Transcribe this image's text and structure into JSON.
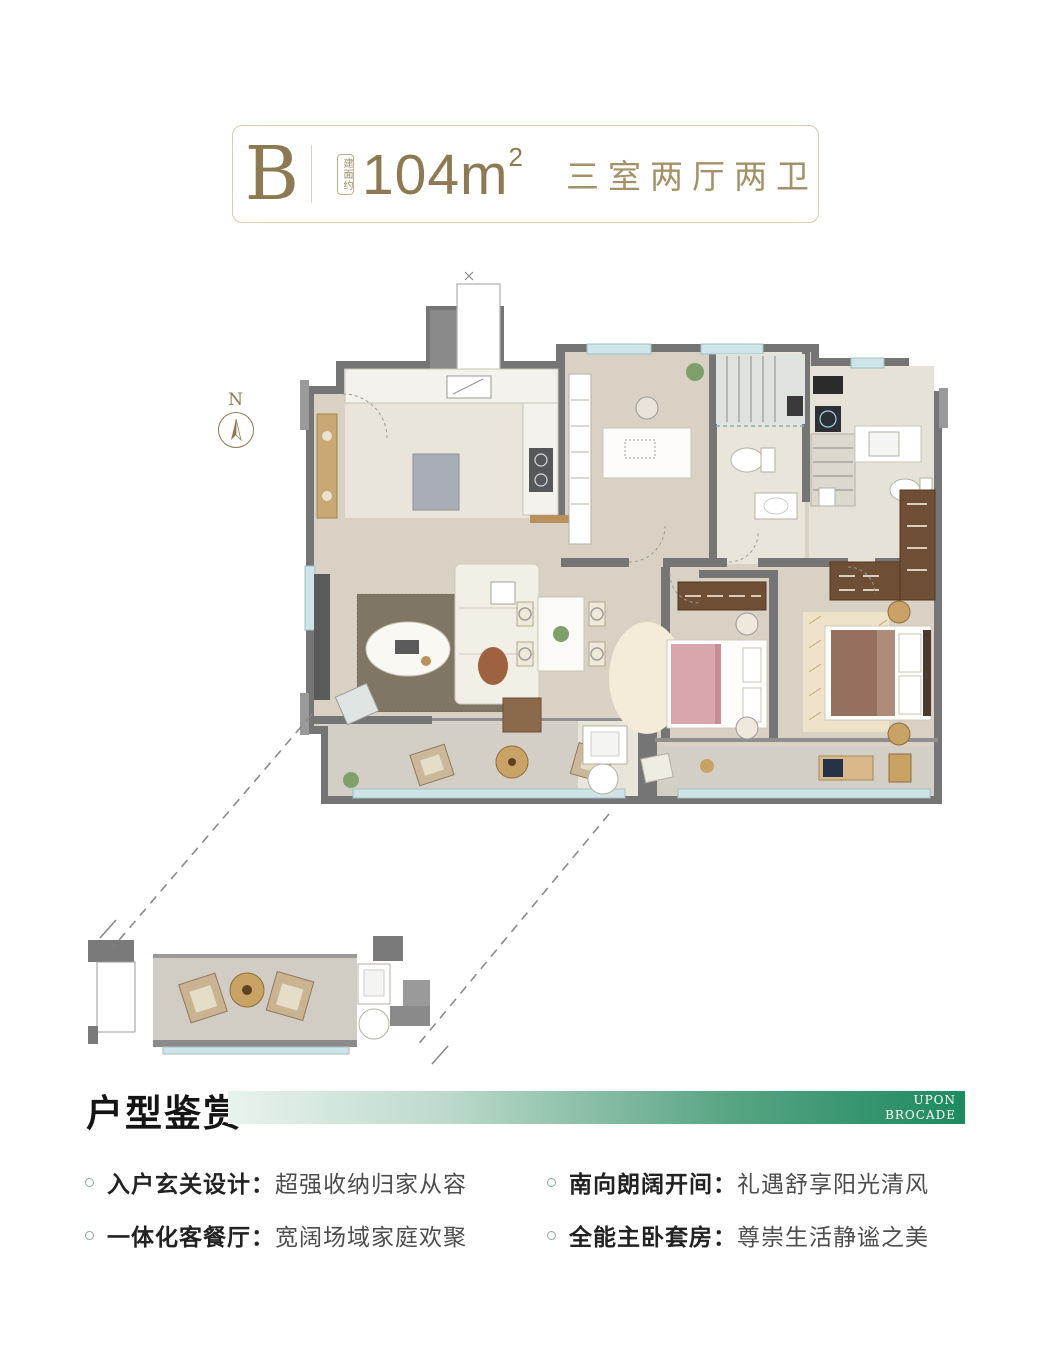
{
  "header": {
    "unit_label": "B",
    "area_badge": "建面约",
    "area_value": "104m",
    "area_superscript": "2",
    "rooms_text": "三室两厅两卫",
    "accent_color": "#8d7a52",
    "border_color": "#d9cdb2"
  },
  "compass": {
    "label": "N"
  },
  "floor_plan": {
    "palette": {
      "wall": "#757575",
      "wall_light": "#9a9a9a",
      "floor_main": "#d9d2c4",
      "floor_light": "#e9e5da",
      "floor_balcony": "#d4cfc6",
      "window": "#cfe4e7",
      "wood_furniture": "#c9a366",
      "wardrobe": "#6f4e36",
      "bed_secondary": "#d9a7ab",
      "bed_master": "#96705e"
    }
  },
  "section": {
    "title": "户型鉴赏",
    "brand_line1": "UPON",
    "brand_line2": "BROCADE",
    "bar_gradient_start": "#e9f3ee",
    "bar_gradient_end": "#1e8a5f"
  },
  "features": [
    {
      "label": "入户玄关设计：",
      "desc": "超强收纳归家从容"
    },
    {
      "label": "一体化客餐厅：",
      "desc": "宽阔场域家庭欢聚"
    },
    {
      "label": "南向朗阔开间：",
      "desc": "礼遇舒享阳光清风"
    },
    {
      "label": "全能主卧套房：",
      "desc": "尊崇生活静谧之美"
    }
  ]
}
